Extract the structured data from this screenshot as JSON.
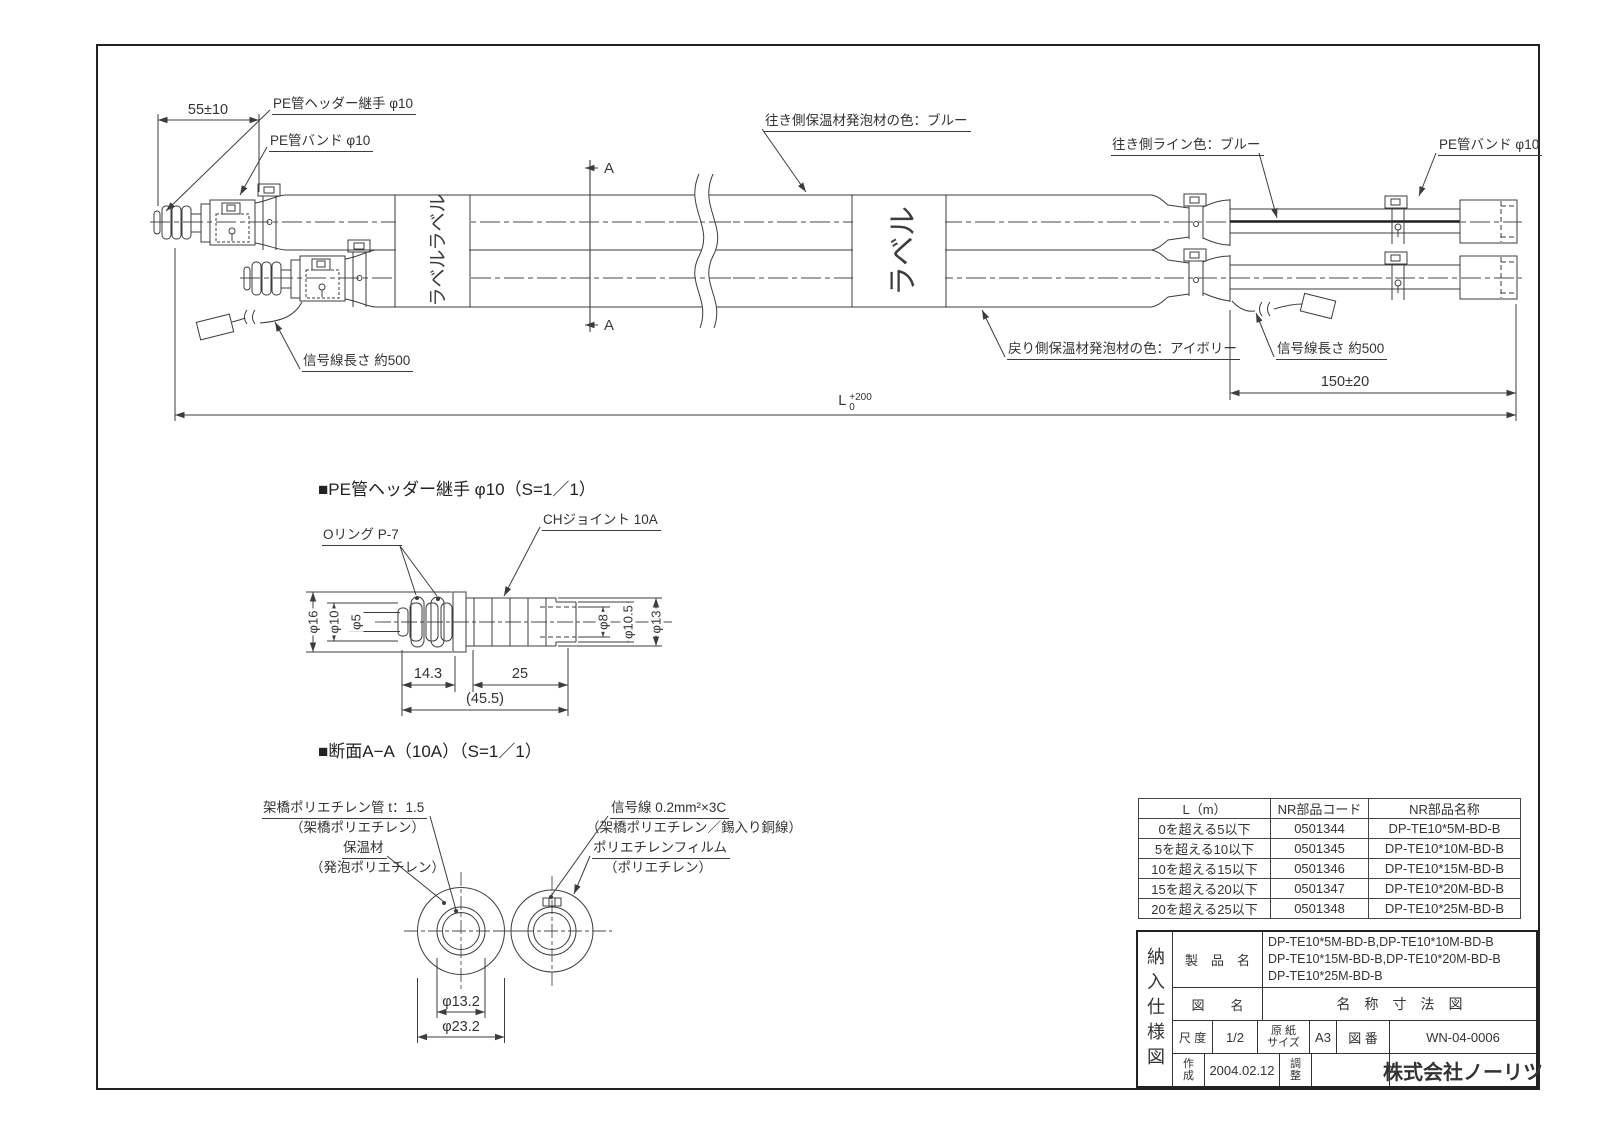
{
  "assembly": {
    "dim_55": "55±10",
    "fitting_label": "PE管ヘッダー継手 φ10",
    "band_label_left": "PE管バンド φ10",
    "supply_foam_color_label": "往き側保温材発泡材の色：ブルー",
    "supply_line_color_label": "往き側ライン色：ブルー",
    "band_label_right": "PE管バンド φ10",
    "signal_length_left": "信号線長さ 約500",
    "return_foam_color_label": "戻り側保温材発泡材の色：アイボリー",
    "signal_length_right": "信号線長さ 約500",
    "dim_150": "150±20",
    "dim_L_letter": "L",
    "dim_L_tol_plus": "+200",
    "dim_L_tol_minus": "0",
    "section_letter": "A",
    "pipe_label": "ラベル"
  },
  "fitting_detail": {
    "title": "■PE管ヘッダー継手 φ10（S=1／1）",
    "oring_label": "Oリング P-7",
    "ch_joint_label": "CHジョイント 10A",
    "dia16": "φ16",
    "dia10": "φ10",
    "dia5": "φ5",
    "dia8": "φ8",
    "dia10_5": "φ10.5",
    "dia13": "φ13",
    "len14_3": "14.3",
    "len25": "25",
    "len45_5": "(45.5)"
  },
  "cross_section": {
    "title": "■断面A−A（10A）（S=1／1）",
    "pex_pipe_label": "架橋ポリエチレン管 t：1.5",
    "pex_pipe_sub": "（架橋ポリエチレン）",
    "insulation_label": "保温材",
    "insulation_sub": "（発泡ポリエチレン）",
    "signal_label": "信号線 0.2mm²×3C",
    "signal_sub": "（架橋ポリエチレン／錫入り銅線）",
    "film_label": "ポリエチレンフィルム",
    "film_sub": "（ポリエチレン）",
    "dia13_2": "φ13.2",
    "dia23_2": "φ23.2"
  },
  "parts_table": {
    "headers": [
      "L（m）",
      "NR部品コード",
      "NR部品名称"
    ],
    "rows": [
      [
        "0を超える5以下",
        "0501344",
        "DP-TE10*5M-BD-B"
      ],
      [
        "5を超える10以下",
        "0501345",
        "DP-TE10*10M-BD-B"
      ],
      [
        "10を超える15以下",
        "0501346",
        "DP-TE10*15M-BD-B"
      ],
      [
        "15を超える20以下",
        "0501347",
        "DP-TE10*20M-BD-B"
      ],
      [
        "20を超える25以下",
        "0501348",
        "DP-TE10*25M-BD-B"
      ]
    ]
  },
  "title_block": {
    "doc_type": "納入仕様図",
    "product_label": "製　品　名",
    "product_line1": "DP-TE10*5M-BD-B,DP-TE10*10M-BD-B",
    "product_line2": "DP-TE10*15M-BD-B,DP-TE10*20M-BD-B",
    "product_line3": "DP-TE10*25M-BD-B",
    "drawing_name_label": "図　　名",
    "drawing_name": "名　称　寸　法　図",
    "scale_label": "尺 度",
    "scale_value": "1/2",
    "paper_label_top": "原 紙",
    "paper_label_bottom": "サイズ",
    "paper_value": "A3",
    "drawing_no_label": "図 番",
    "drawing_no_value": "WN-04-0006",
    "created_label_top": "作",
    "created_label_bottom": "成",
    "created_value": "2004.02.12",
    "adjust_label_top": "調",
    "adjust_label_bottom": "整",
    "company": "株式会社ノーリツ"
  }
}
